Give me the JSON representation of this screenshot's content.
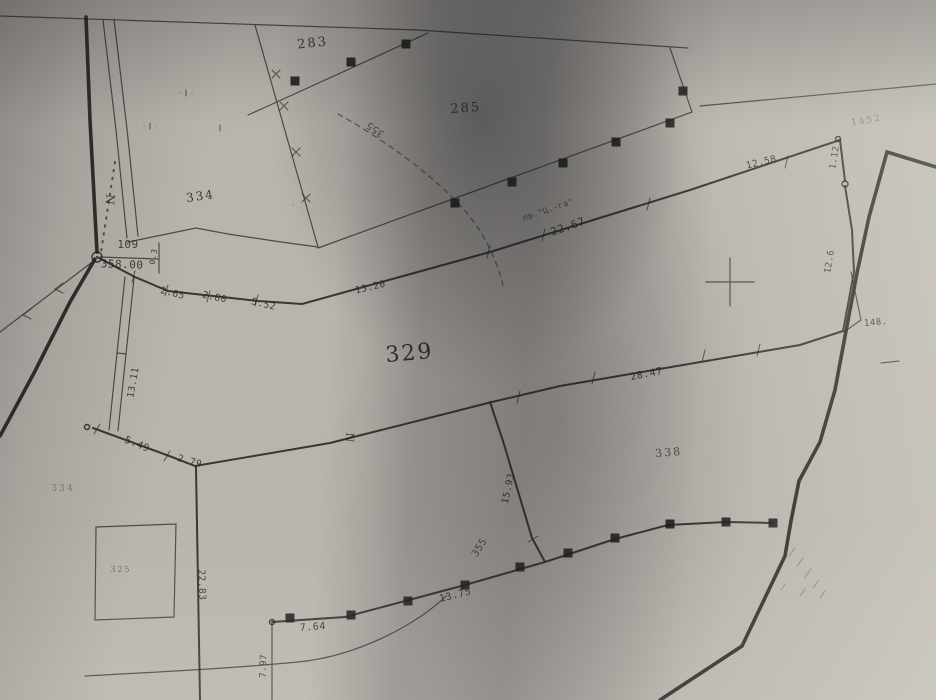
{
  "map": {
    "labels": [
      {
        "cls": "parcel",
        "text": "283",
        "x": 313,
        "y": 47,
        "rot": -6,
        "size": 13,
        "op": 0.85
      },
      {
        "cls": "parcel",
        "text": "285",
        "x": 466,
        "y": 112,
        "rot": -4,
        "size": 13,
        "op": 0.8
      },
      {
        "cls": "parcel",
        "text": "334",
        "x": 201,
        "y": 200,
        "rot": -8,
        "size": 12,
        "op": 0.85
      },
      {
        "cls": "parcel",
        "text": "329",
        "x": 410,
        "y": 360,
        "rot": -5,
        "size": 22,
        "op": 0.9
      },
      {
        "cls": "parcel",
        "text": "338",
        "x": 669,
        "y": 456,
        "rot": -5,
        "size": 11,
        "op": 0.7
      },
      {
        "cls": "parcel",
        "text": "334",
        "x": 63,
        "y": 491,
        "rot": 0,
        "size": 9,
        "op": 0.38
      },
      {
        "cls": "parcel",
        "text": "325",
        "x": 121,
        "y": 572,
        "rot": 0,
        "size": 8,
        "op": 0.5
      },
      {
        "cls": "parcel",
        "text": "1452",
        "x": 867,
        "y": 123,
        "rot": -10,
        "size": 9,
        "op": 0.38
      },
      {
        "cls": "meas",
        "text": "2.65",
        "x": 172,
        "y": 296,
        "rot": 14,
        "size": 9.5
      },
      {
        "cls": "meas",
        "text": "2.80",
        "x": 214,
        "y": 300,
        "rot": 12,
        "size": 9.5
      },
      {
        "cls": "meas",
        "text": "5.52",
        "x": 263,
        "y": 307,
        "rot": 14,
        "size": 9.5
      },
      {
        "cls": "meas",
        "text": "13.20",
        "x": 371,
        "y": 290,
        "rot": -13,
        "size": 9.5
      },
      {
        "cls": "meas",
        "text": "22.67",
        "x": 569,
        "y": 230,
        "rot": -19,
        "size": 11
      },
      {
        "cls": "meas",
        "text": "12.58",
        "x": 762,
        "y": 165,
        "rot": -14,
        "size": 9.5
      },
      {
        "cls": "meas",
        "text": "1.12",
        "x": 837,
        "y": 158,
        "rot": -80,
        "size": 9
      },
      {
        "cls": "meas",
        "text": "12.6",
        "x": 832,
        "y": 262,
        "rot": -80,
        "size": 9
      },
      {
        "cls": "meas",
        "text": "148.",
        "x": 876,
        "y": 325,
        "rot": -5,
        "size": 9
      },
      {
        "cls": "meas",
        "text": "28.47",
        "x": 647,
        "y": 377,
        "rot": -11,
        "size": 10
      },
      {
        "cls": "meas",
        "text": "15.93",
        "x": 511,
        "y": 489,
        "rot": -78,
        "size": 9.5
      },
      {
        "cls": "meas",
        "text": "13.75",
        "x": 456,
        "y": 598,
        "rot": -14,
        "size": 10
      },
      {
        "cls": "meas",
        "text": "7.64",
        "x": 313,
        "y": 630,
        "rot": -4,
        "size": 10
      },
      {
        "cls": "meas",
        "text": "7.97",
        "x": 266,
        "y": 666,
        "rot": -88,
        "size": 9
      },
      {
        "cls": "meas",
        "text": "22.83",
        "x": 199,
        "y": 585,
        "rot": 88,
        "size": 9.5
      },
      {
        "cls": "meas",
        "text": "5.49",
        "x": 136,
        "y": 447,
        "rot": 22,
        "size": 10
      },
      {
        "cls": "meas",
        "text": "2.79",
        "x": 189,
        "y": 464,
        "rot": 16,
        "size": 9.5
      },
      {
        "cls": "meas",
        "text": "13.11",
        "x": 136,
        "y": 383,
        "rot": -80,
        "size": 9.5
      },
      {
        "cls": "meas",
        "text": "0.3",
        "x": 156,
        "y": 257,
        "rot": -80,
        "size": 8
      },
      {
        "cls": "meas",
        "text": "355",
        "x": 377,
        "y": 127,
        "rot": -145,
        "size": 10,
        "op": 0.65
      },
      {
        "cls": "meas",
        "text": "355",
        "x": 482,
        "y": 549,
        "rot": -58,
        "size": 10,
        "op": 0.7
      },
      {
        "cls": "point",
        "text": "109",
        "x": 128,
        "y": 248,
        "rot": 0,
        "size": 11
      },
      {
        "cls": "point",
        "text": "358.00",
        "x": 122,
        "y": 268,
        "rot": 2,
        "size": 11
      },
      {
        "cls": "street",
        "text": "пр.\"Ц.-га\"",
        "x": 549,
        "y": 212,
        "rot": -19,
        "size": 8,
        "op": 0.7
      },
      {
        "cls": "north",
        "text": "N",
        "x": 106,
        "y": 199,
        "rot": 96,
        "size": 12,
        "op": 0.8
      },
      {
        "cls": "north",
        "text": "N",
        "x": 346,
        "y": 437,
        "rot": 96,
        "size": 11,
        "op": 0.85
      }
    ],
    "colors": {
      "paper": "#b9b5ae",
      "ink": "#25231e"
    }
  }
}
